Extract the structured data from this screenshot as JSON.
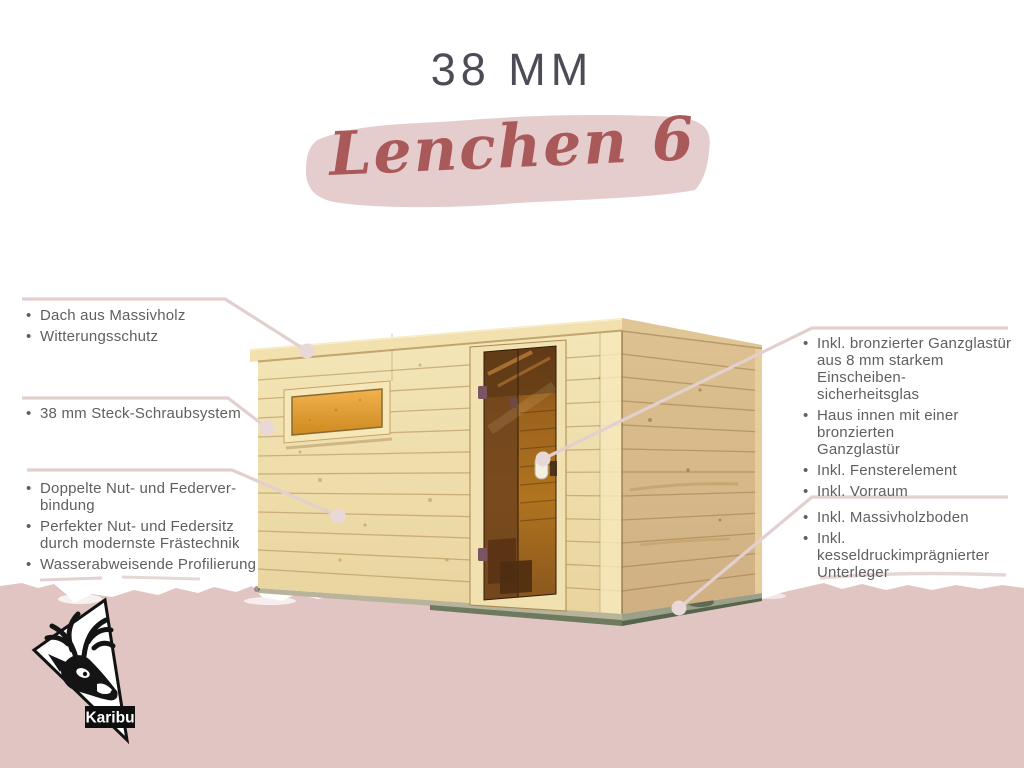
{
  "header": {
    "title": "38 MM",
    "product_name": "Lenchen 6"
  },
  "ui": {
    "bullet": "•"
  },
  "brand": {
    "name": "Karibu"
  },
  "colors": {
    "background": "#ffffff",
    "bottom_band_pink": "#e0c5c3",
    "swash_pink": "#e5cdcd",
    "connector_line_pink": "#e4cfcf",
    "title_gray": "#4c4c56",
    "product_name_red": "#a95959",
    "callout_text_gray": "#5f5f5f",
    "wood_front": "#f2e2b2",
    "wood_side": "#d9bd92",
    "window_glow_amber": "#eba73c",
    "door_glass_bronze": "#9c621c"
  },
  "callouts": {
    "left": [
      {
        "items": [
          {
            "lines": [
              "Dach aus Massivholz"
            ]
          },
          {
            "lines": [
              "Witterungsschutz"
            ]
          }
        ]
      },
      {
        "items": [
          {
            "lines": [
              "38 mm Steck-Schraubsystem"
            ]
          }
        ]
      },
      {
        "items": [
          {
            "lines": [
              "Doppelte Nut- und Federver-",
              "bindung"
            ]
          },
          {
            "lines": [
              "Perfekter Nut- und Federsitz",
              "durch modernste Frästechnik"
            ]
          },
          {
            "lines": [
              "Wasserabweisende Profilierung"
            ]
          }
        ]
      }
    ],
    "right": [
      {
        "items": [
          {
            "lines": [
              "Inkl. bronzierter Ganzglastür",
              "aus 8 mm starkem Einscheiben-",
              "sicherheitsglas"
            ]
          },
          {
            "lines": [
              "Haus innen mit einer bronzierten",
              "Ganzglastür"
            ]
          },
          {
            "lines": [
              "Inkl. Fensterelement"
            ]
          },
          {
            "lines": [
              "Inkl. Vorraum"
            ]
          }
        ]
      },
      {
        "items": [
          {
            "lines": [
              "Inkl. Massivholzboden"
            ]
          },
          {
            "lines": [
              "Inkl. kesseldruckimprägnierter",
              "Unterleger"
            ]
          }
        ]
      }
    ]
  }
}
